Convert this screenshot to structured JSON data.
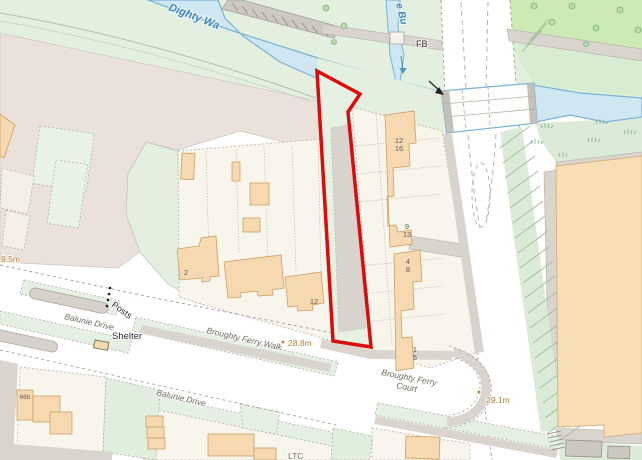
{
  "map": {
    "type": "street-map",
    "selection_color": "#dd0b0b",
    "water_color": "#cfe6f3",
    "building_color": "#f6d9b0",
    "labels": {
      "river": "Dighty Wa",
      "stream": "e Bu",
      "footbridge": "FB",
      "posts": "Posts",
      "shelter": "Shelter",
      "balunie_drive_west": "Balunie Drive",
      "balunie_drive_south": "Balunie Drive",
      "broughty_ferry_walk": "Broughty Ferry Walk",
      "broughty_ferry_court_line1": "Broughty Ferry",
      "broughty_ferry_court_line2": "Court",
      "partial_bottom": "LTC"
    },
    "spot_heights": {
      "west": "9.5m",
      "walk": "28.8m",
      "court": "29.1m"
    },
    "house_numbers": [
      "12",
      "16",
      "9",
      "13",
      "4",
      "8",
      "1",
      "5",
      "2",
      "12",
      "66b"
    ]
  }
}
